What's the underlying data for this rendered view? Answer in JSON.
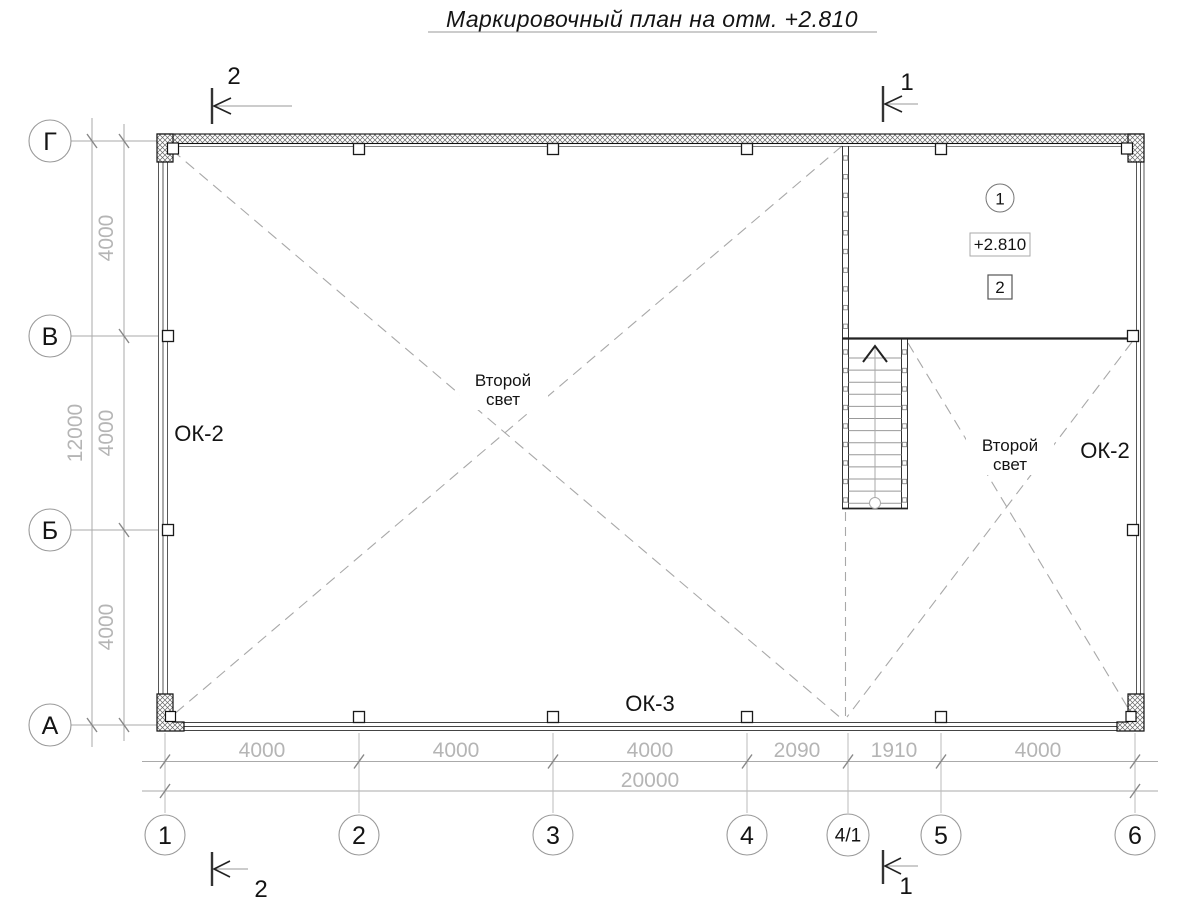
{
  "title": "Маркировочный план на отм. +2.810",
  "grid_axes": {
    "rows": [
      "Г",
      "В",
      "Б",
      "А"
    ],
    "cols": [
      "1",
      "2",
      "3",
      "4",
      "4/1",
      "5",
      "6"
    ]
  },
  "dimensions": {
    "row_segments": [
      "4000",
      "4000",
      "4000"
    ],
    "rows_total": "12000",
    "col_segments": [
      "4000",
      "4000",
      "4000",
      "2090",
      "1910",
      "4000"
    ],
    "cols_total": "20000"
  },
  "section_marks": {
    "top_left": "2",
    "top_right": "1",
    "bottom_left": "2",
    "bottom_right": "1"
  },
  "labels": {
    "void_left_line1": "Второй",
    "void_left_line2": "свет",
    "void_right_line1": "Второй",
    "void_right_line2": "свет",
    "window_mark_left": "ОК-2",
    "window_mark_right": "ОК-2",
    "window_mark_bottom": "ОК-3",
    "room_number": "1",
    "elevation_mark": "+2.810",
    "wall_type_mark": "2"
  },
  "colors": {
    "wall_dark": "#1a1a1a",
    "grid_gray": "#a8a8a8",
    "dim_text_gray": "#b5b5b5"
  }
}
